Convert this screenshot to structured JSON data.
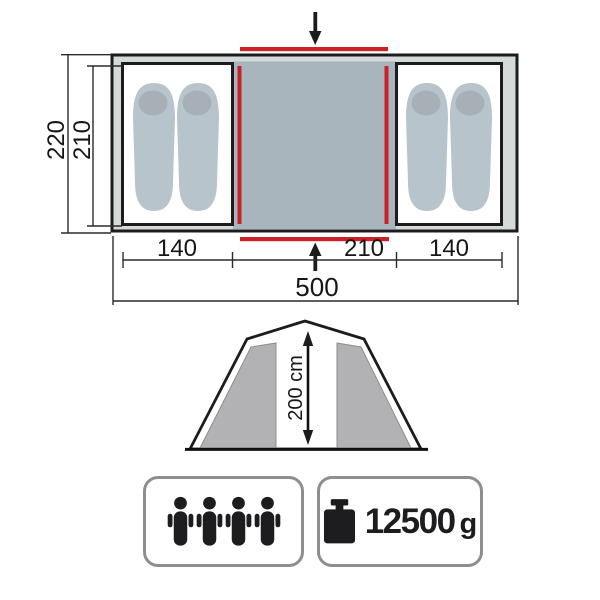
{
  "floor_plan": {
    "outer_depth": "220",
    "inner_depth": "210",
    "left_cabin_width": "140",
    "center_width": "210",
    "right_cabin_width": "140",
    "total_width": "500"
  },
  "side_view": {
    "height_label": "200 cm"
  },
  "badges": {
    "capacity": {
      "persons": 4,
      "icon": "person-icon"
    },
    "weight": {
      "icon": "weight-icon",
      "value": "12500",
      "unit": "g"
    }
  },
  "colors": {
    "red": "#c92127",
    "outline": "#1c1c1e",
    "tent_fill": "#d3dad7",
    "center_fill": "#a9b5bc",
    "pad_fill": "#b8c4cb",
    "pillow_fill": "#a6b0b6",
    "panel_fill": "#b2b2b4",
    "box_border": "#8e8e8e"
  }
}
